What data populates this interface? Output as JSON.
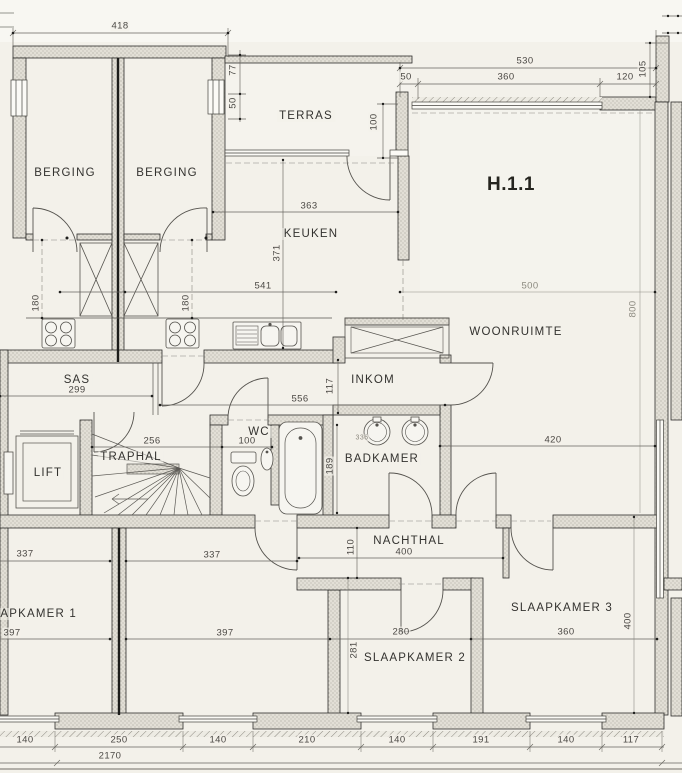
{
  "unit_label": "H.1.1",
  "colors": {
    "paper": "#f3f1ea",
    "wall_line": "#2e2d2b",
    "wall_fill": "#e2dfd6",
    "dim_text": "#4a4844"
  },
  "rooms": [
    {
      "id": "berging-1",
      "label": "BERGING",
      "x": 65,
      "y": 173
    },
    {
      "id": "berging-2",
      "label": "BERGING",
      "x": 167,
      "y": 173
    },
    {
      "id": "terras",
      "label": "TERRAS",
      "x": 306,
      "y": 116
    },
    {
      "id": "keuken",
      "label": "KEUKEN",
      "x": 311,
      "y": 234
    },
    {
      "id": "woonruimte",
      "label": "WOONRUIMTE",
      "x": 516,
      "y": 332
    },
    {
      "id": "sas",
      "label": "SAS",
      "x": 77,
      "y": 380
    },
    {
      "id": "inkom",
      "label": "INKOM",
      "x": 373,
      "y": 380
    },
    {
      "id": "wc",
      "label": "WC",
      "x": 259,
      "y": 432
    },
    {
      "id": "badkamer",
      "label": "BADKAMER",
      "x": 382,
      "y": 459
    },
    {
      "id": "traphal",
      "label": "TRAPHAL",
      "x": 131,
      "y": 457
    },
    {
      "id": "lift",
      "label": "LIFT",
      "x": 48,
      "y": 473
    },
    {
      "id": "nachthal",
      "label": "NACHTHAL",
      "x": 409,
      "y": 541
    },
    {
      "id": "slaapkamer-1",
      "label": "SLAAPKAMER 1",
      "x": 26,
      "y": 614
    },
    {
      "id": "slaapkamer-2",
      "label": "SLAAPKAMER 2",
      "x": 415,
      "y": 658
    },
    {
      "id": "slaapkamer-3",
      "label": "SLAAPKAMER 3",
      "x": 562,
      "y": 608
    }
  ],
  "dimensions": [
    {
      "v": "418",
      "x": 120,
      "y": 26
    },
    {
      "v": "77",
      "x": 233,
      "y": 70,
      "r": 1
    },
    {
      "v": "50",
      "x": 233,
      "y": 103,
      "r": 1
    },
    {
      "v": "530",
      "x": 525,
      "y": 61
    },
    {
      "v": "50",
      "x": 406,
      "y": 77
    },
    {
      "v": "360",
      "x": 506,
      "y": 77
    },
    {
      "v": "120",
      "x": 625,
      "y": 77
    },
    {
      "v": "105",
      "x": 643,
      "y": 69,
      "r": 1
    },
    {
      "v": "100",
      "x": 374,
      "y": 122,
      "r": 1
    },
    {
      "v": "363",
      "x": 309,
      "y": 206
    },
    {
      "v": "371",
      "x": 277,
      "y": 253,
      "r": 1
    },
    {
      "v": "541",
      "x": 263,
      "y": 286
    },
    {
      "v": "500",
      "x": 530,
      "y": 286,
      "f": 1
    },
    {
      "v": "180",
      "x": 36,
      "y": 303,
      "r": 1
    },
    {
      "v": "180",
      "x": 186,
      "y": 303,
      "r": 1
    },
    {
      "v": "800",
      "x": 633,
      "y": 309,
      "r": 1,
      "f": 1
    },
    {
      "v": "299",
      "x": 77,
      "y": 390
    },
    {
      "v": "117",
      "x": 330,
      "y": 386,
      "r": 1
    },
    {
      "v": "556",
      "x": 300,
      "y": 399
    },
    {
      "v": "256",
      "x": 152,
      "y": 441
    },
    {
      "v": "100",
      "x": 247,
      "y": 441
    },
    {
      "v": "336",
      "x": 362,
      "y": 438,
      "t": 1
    },
    {
      "v": "420",
      "x": 553,
      "y": 440
    },
    {
      "v": "189",
      "x": 330,
      "y": 466,
      "r": 1
    },
    {
      "v": "110",
      "x": 351,
      "y": 547,
      "r": 1
    },
    {
      "v": "400",
      "x": 404,
      "y": 552
    },
    {
      "v": "337",
      "x": 25,
      "y": 554
    },
    {
      "v": "337",
      "x": 212,
      "y": 555
    },
    {
      "v": "397",
      "x": 12,
      "y": 633
    },
    {
      "v": "397",
      "x": 225,
      "y": 633
    },
    {
      "v": "280",
      "x": 401,
      "y": 632
    },
    {
      "v": "281",
      "x": 354,
      "y": 650,
      "r": 1
    },
    {
      "v": "360",
      "x": 566,
      "y": 632
    },
    {
      "v": "400",
      "x": 628,
      "y": 621,
      "r": 1
    },
    {
      "v": "140",
      "x": 25,
      "y": 740
    },
    {
      "v": "250",
      "x": 119,
      "y": 740
    },
    {
      "v": "140",
      "x": 218,
      "y": 740
    },
    {
      "v": "210",
      "x": 307,
      "y": 740
    },
    {
      "v": "140",
      "x": 397,
      "y": 740
    },
    {
      "v": "191",
      "x": 481,
      "y": 740
    },
    {
      "v": "140",
      "x": 566,
      "y": 740
    },
    {
      "v": "117",
      "x": 631,
      "y": 740
    },
    {
      "v": "2170",
      "x": 110,
      "y": 756
    }
  ]
}
